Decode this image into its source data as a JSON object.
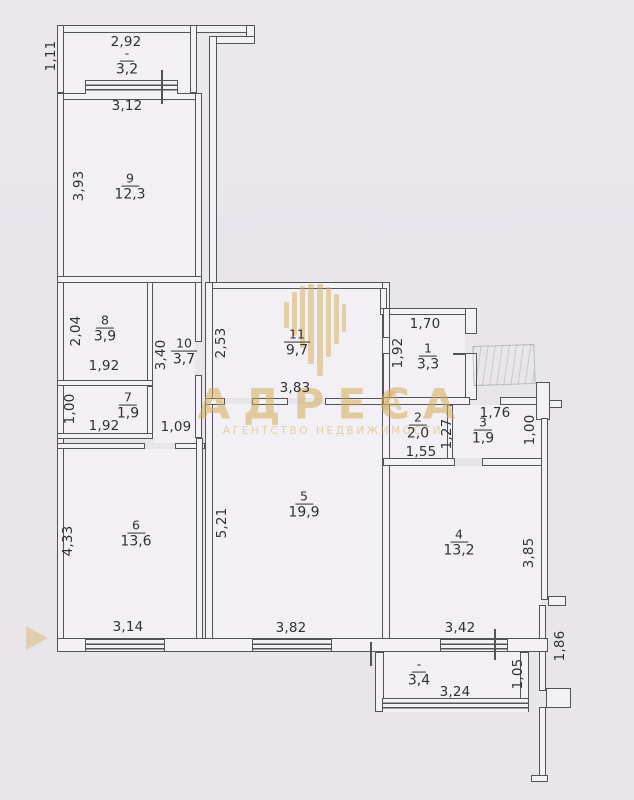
{
  "watermark": {
    "brand": "АДРЕСА",
    "tagline": "АГЕНТСТВО НЕДВИЖИМОСТИ",
    "partial_letter": "А"
  },
  "rooms": {
    "balcony_top": {
      "number": "-",
      "area": "3,2"
    },
    "r9": {
      "number": "9",
      "area": "12,3"
    },
    "r8": {
      "number": "8",
      "area": "3,9"
    },
    "r10": {
      "number": "10",
      "area": "3,7"
    },
    "r7": {
      "number": "7",
      "area": "1,9"
    },
    "r11": {
      "number": "11",
      "area": "9,7"
    },
    "r1": {
      "number": "1",
      "area": "3,3"
    },
    "r2": {
      "number": "2",
      "area": "2,0"
    },
    "r3": {
      "number": "3",
      "area": "1,9"
    },
    "r5": {
      "number": "5",
      "area": "19,9"
    },
    "r6": {
      "number": "6",
      "area": "13,6"
    },
    "r4": {
      "number": "4",
      "area": "13,2"
    },
    "balcony_bottom": {
      "number": "-",
      "area": "3,4"
    }
  },
  "dimensions": {
    "balcony_top_width": "2,92",
    "balcony_top_depth": "1,11",
    "r9_width": "3,12",
    "r9_depth": "3,93",
    "r8_depth": "2,04",
    "r8_width": "1,92",
    "r10_depth": "3,40",
    "r10_width": "1,09",
    "r7_depth": "1,00",
    "r7_width": "1,92",
    "r11_depth": "2,53",
    "r11_width": "3,83",
    "r1_width": "1,70",
    "r1_depth": "1,92",
    "r2_width": "1,55",
    "r2_depth": "1,27",
    "r3_width": "1,76",
    "r3_depth": "1,00",
    "r5_depth": "5,21",
    "r5_width": "3,82",
    "r6_depth": "4,33",
    "r6_width": "3,14",
    "r4_depth": "3,85",
    "r4_width": "3,42",
    "stair_depth": "1,86",
    "balcony_bottom_depth": "1,05",
    "balcony_bottom_width": "3,24"
  },
  "colors": {
    "paper": "#e9e7ec",
    "line": "#54535c",
    "text": "#313036",
    "watermark_gold": "#d2ab57"
  }
}
